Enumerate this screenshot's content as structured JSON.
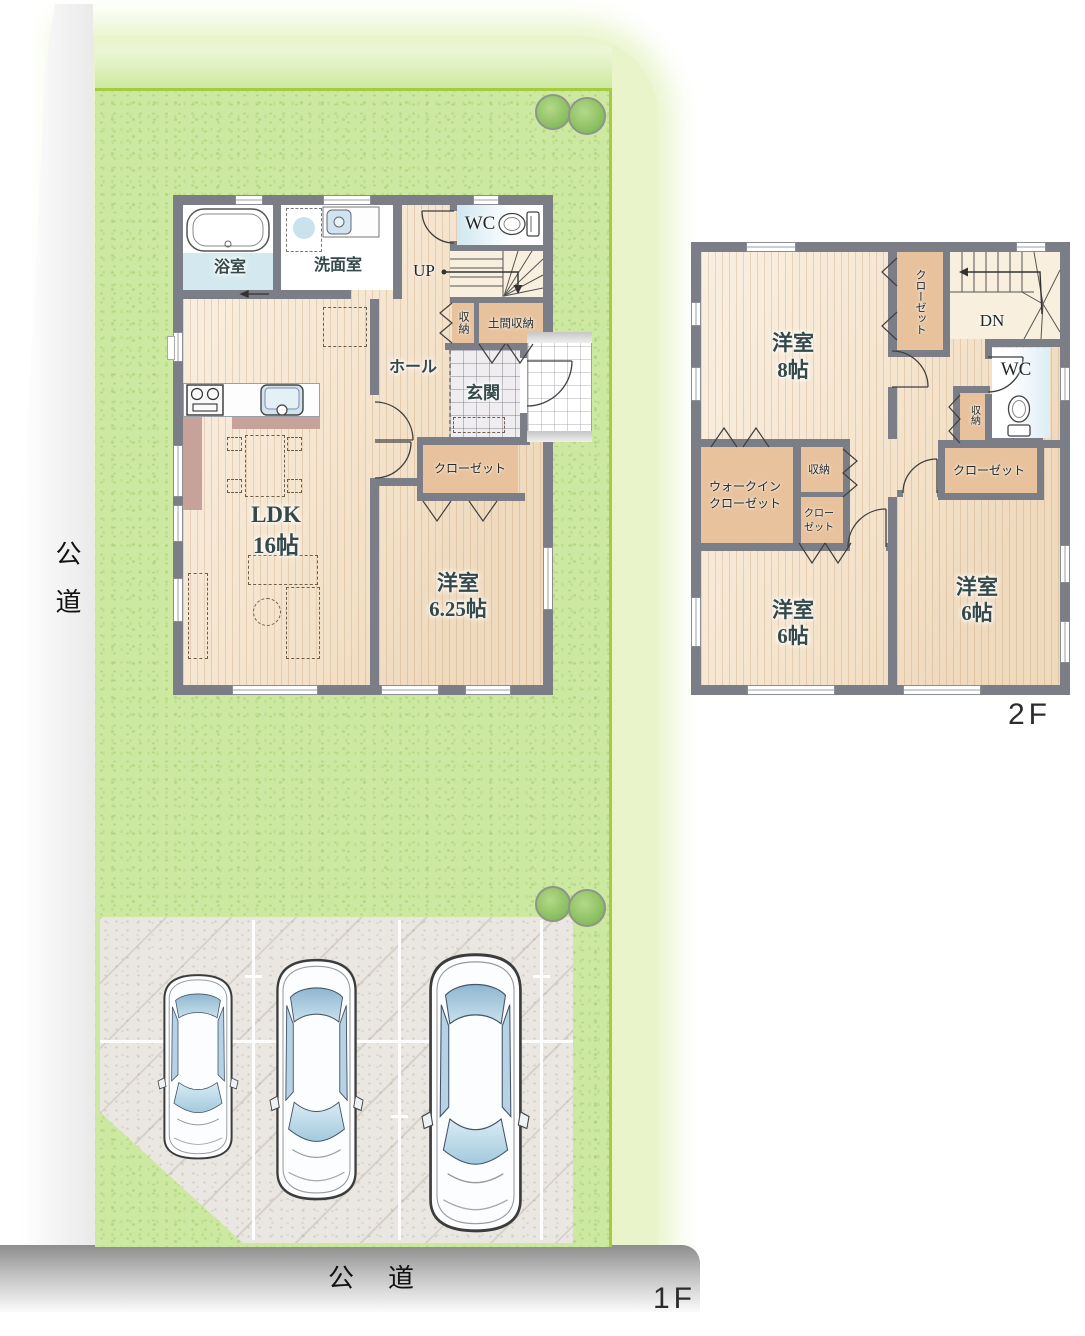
{
  "site": {
    "road_left_label": "公道",
    "road_bottom_label": "公道",
    "floor1_label": "1F",
    "floor2_label": "2F"
  },
  "floor1": {
    "bath": "浴室",
    "washroom": "洗面室",
    "wc": "WC",
    "up": "UP",
    "hall": "ホール",
    "storage": "収納",
    "doma_storage": "土間収納",
    "genkan": "玄関",
    "closet": "クローゼット",
    "ldk": "LDK",
    "ldk_size": "16帖",
    "bedroom": "洋室",
    "bedroom_size": "6.25帖"
  },
  "floor2": {
    "bedroom8": "洋室",
    "bedroom8_size": "8帖",
    "closet_top": "クローゼット",
    "dn": "DN",
    "wc": "WC",
    "storage_wc": "収納",
    "closet_right": "クローゼット",
    "wic": [
      "ウォークイン",
      "クローゼット"
    ],
    "storage_mid": "収納",
    "closet_mid": [
      "クロー",
      "ゼット"
    ],
    "bedroom6_left": "洋室",
    "bedroom6_left_size": "6帖",
    "bedroom6_right": "洋室",
    "bedroom6_right_size": "6帖"
  },
  "colors": {
    "wall": "#7b7e87",
    "wood_floor": "#f5e5cf",
    "closet_fill": "#e7c29c",
    "lawn": "#cde9a1",
    "lawn_border": "#a5cb40",
    "paving": "#eae7e2",
    "label_text": "#35494a",
    "car_window": "#aecfe3"
  }
}
